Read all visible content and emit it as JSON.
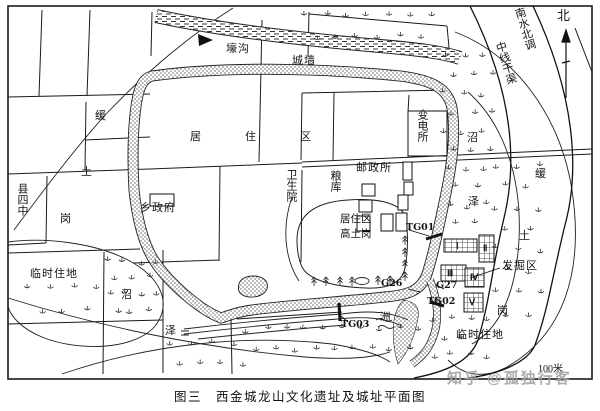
{
  "figure": {
    "caption": "图三　西金城龙山文化遗址及城址平面图",
    "watermark": "知乎 @孤独行客",
    "scale_label": "100米",
    "north_label": "北"
  },
  "canal": {
    "line1": "南水北调",
    "line2": "中线干渠"
  },
  "city": {
    "moat": "壕沟",
    "wall": "城墙"
  },
  "zones": {
    "residential_top": "居住区",
    "residential_inner": "居住区",
    "high_mound": "高土岗",
    "excavation_area": "发掘区",
    "temp_camp_left": "临时住地",
    "temp_camp_right": "临时住地"
  },
  "terrain": {
    "huan_left": "缓",
    "tu_left": "土",
    "gang_left": "岗",
    "zhao_left": "沼",
    "ze_left": "泽",
    "huan_right": "缓",
    "tu_right": "土",
    "gang_right": "岗",
    "zhao_right": "沼",
    "ze_right": "泽",
    "islet": "洲"
  },
  "buildings": {
    "county_school": "县四中",
    "township_gov": "乡政府",
    "clinic": "卫生院",
    "granary": "粮库",
    "post_office": "邮政所",
    "substation": "变电所"
  },
  "excavation": {
    "trenches": [
      "TG01",
      "TG02",
      "TG03"
    ],
    "ditches": [
      "G26",
      "G27"
    ],
    "blocks": [
      "Ⅰ",
      "Ⅱ",
      "Ⅲ",
      "Ⅳ",
      "Ⅴ"
    ]
  },
  "colors": {
    "ink": "#1a1a1a",
    "paper": "#ffffff",
    "watermark": "#a3a3a3"
  }
}
